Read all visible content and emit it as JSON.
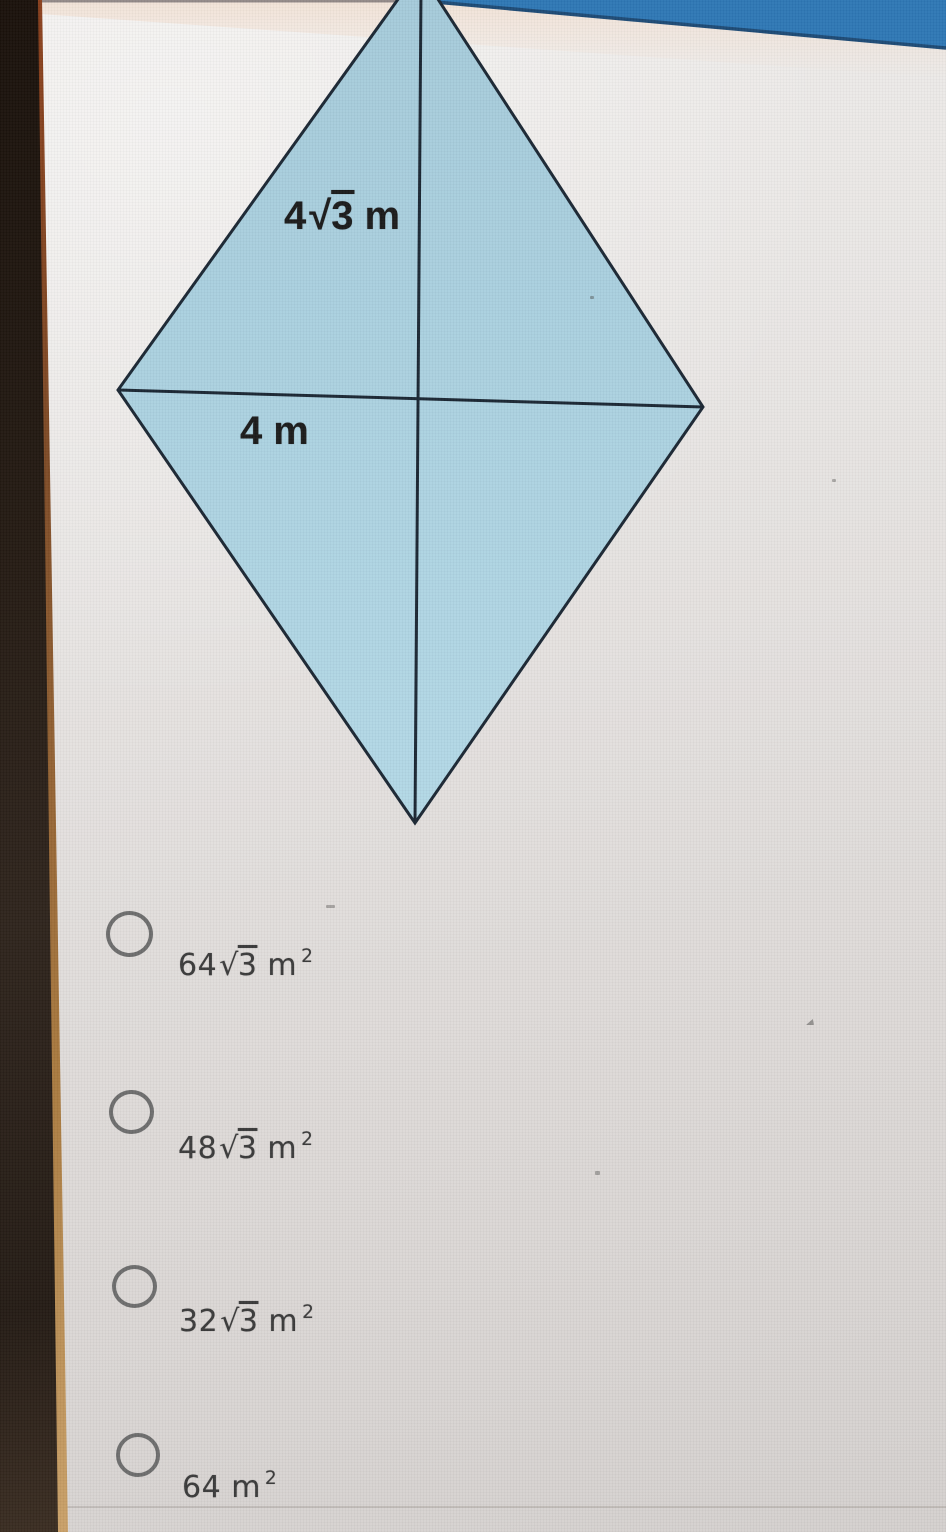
{
  "screen": {
    "background_color": "#e9e6e4",
    "top_bar_color": "#2e77b5",
    "top_bar_edge_color": "#1d4a75",
    "bezel_color": "#241a12",
    "bezel_edge_color": "#a97a3f"
  },
  "figure": {
    "shape": "rhombus-with-diagonals",
    "fill_color": "#aed3e1",
    "outline_color": "#1b2733",
    "upper_label": {
      "coefficient": "4",
      "radical_symbol": "√",
      "radicand": "3",
      "unit": "m"
    },
    "lower_label": {
      "value": "4",
      "unit": "m"
    }
  },
  "options": [
    {
      "coefficient": "64",
      "radical_symbol": "√",
      "radicand": "3",
      "unit": "m",
      "exponent": "2"
    },
    {
      "coefficient": "48",
      "radical_symbol": "√",
      "radicand": "3",
      "unit": "m",
      "exponent": "2"
    },
    {
      "coefficient": "32",
      "radical_symbol": "√",
      "radicand": "3",
      "unit": "m",
      "exponent": "2"
    },
    {
      "coefficient": "64",
      "unit": "m",
      "exponent": "2"
    }
  ]
}
